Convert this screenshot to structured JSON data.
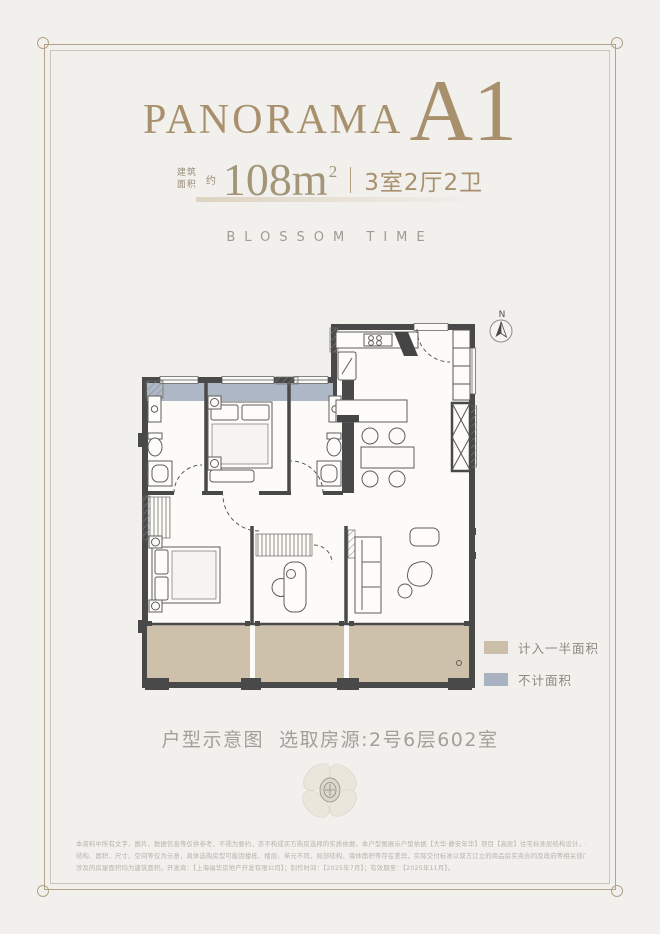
{
  "page": {
    "bg": "#f1f0ed",
    "frame_outer_color": "#b3a387",
    "frame_inner_color": "#c9c5be"
  },
  "header": {
    "brand": "PANORAMA",
    "unit": "A1",
    "accent_color": "#a8906c",
    "area_label_top": "建筑",
    "area_label_bottom": "面积",
    "area_prefix": "约",
    "area_value": "108m",
    "area_exponent": "2",
    "spec_divider_color": "#b4a183",
    "layout": "3室2厅2卫",
    "subtitle": "BLOSSOM TIME"
  },
  "plan": {
    "north_label": "N",
    "wall_color": "#4a494a",
    "half_area_color": "#cec1ac",
    "excluded_area_color": "#aeb7c5",
    "legend": [
      {
        "label": "计入一半面积",
        "color": "#cbbfa9"
      },
      {
        "label": "不计面积",
        "color": "#a9b2c1"
      }
    ]
  },
  "caption": "户型示意图  选取房源:2号6层602室",
  "footer": {
    "lines": [
      "本资料中所有文字、图片、数据信息等仅供参考，不视为要约，亦不构成买方购房选择的实质依据，本户型图展示户型依据【大华·静安年华】项目【高层】住宅标准层结构设计，本资料所示",
      "结构、面积、尺寸、空间等仅为示意，具体选购房型可能因楼栋、楼层、单元不同，局部结构、墙体面积等存在差异，实际交付标准以双方订立的商品房买卖合同及政府等相关部门的批准文件为准，",
      "涉及的房屋面积均为建筑面积。开发商：【上海福华房地产开发有限公司】；制作时间：【2025年7月】；有效期至：【2025年11月】。"
    ]
  }
}
